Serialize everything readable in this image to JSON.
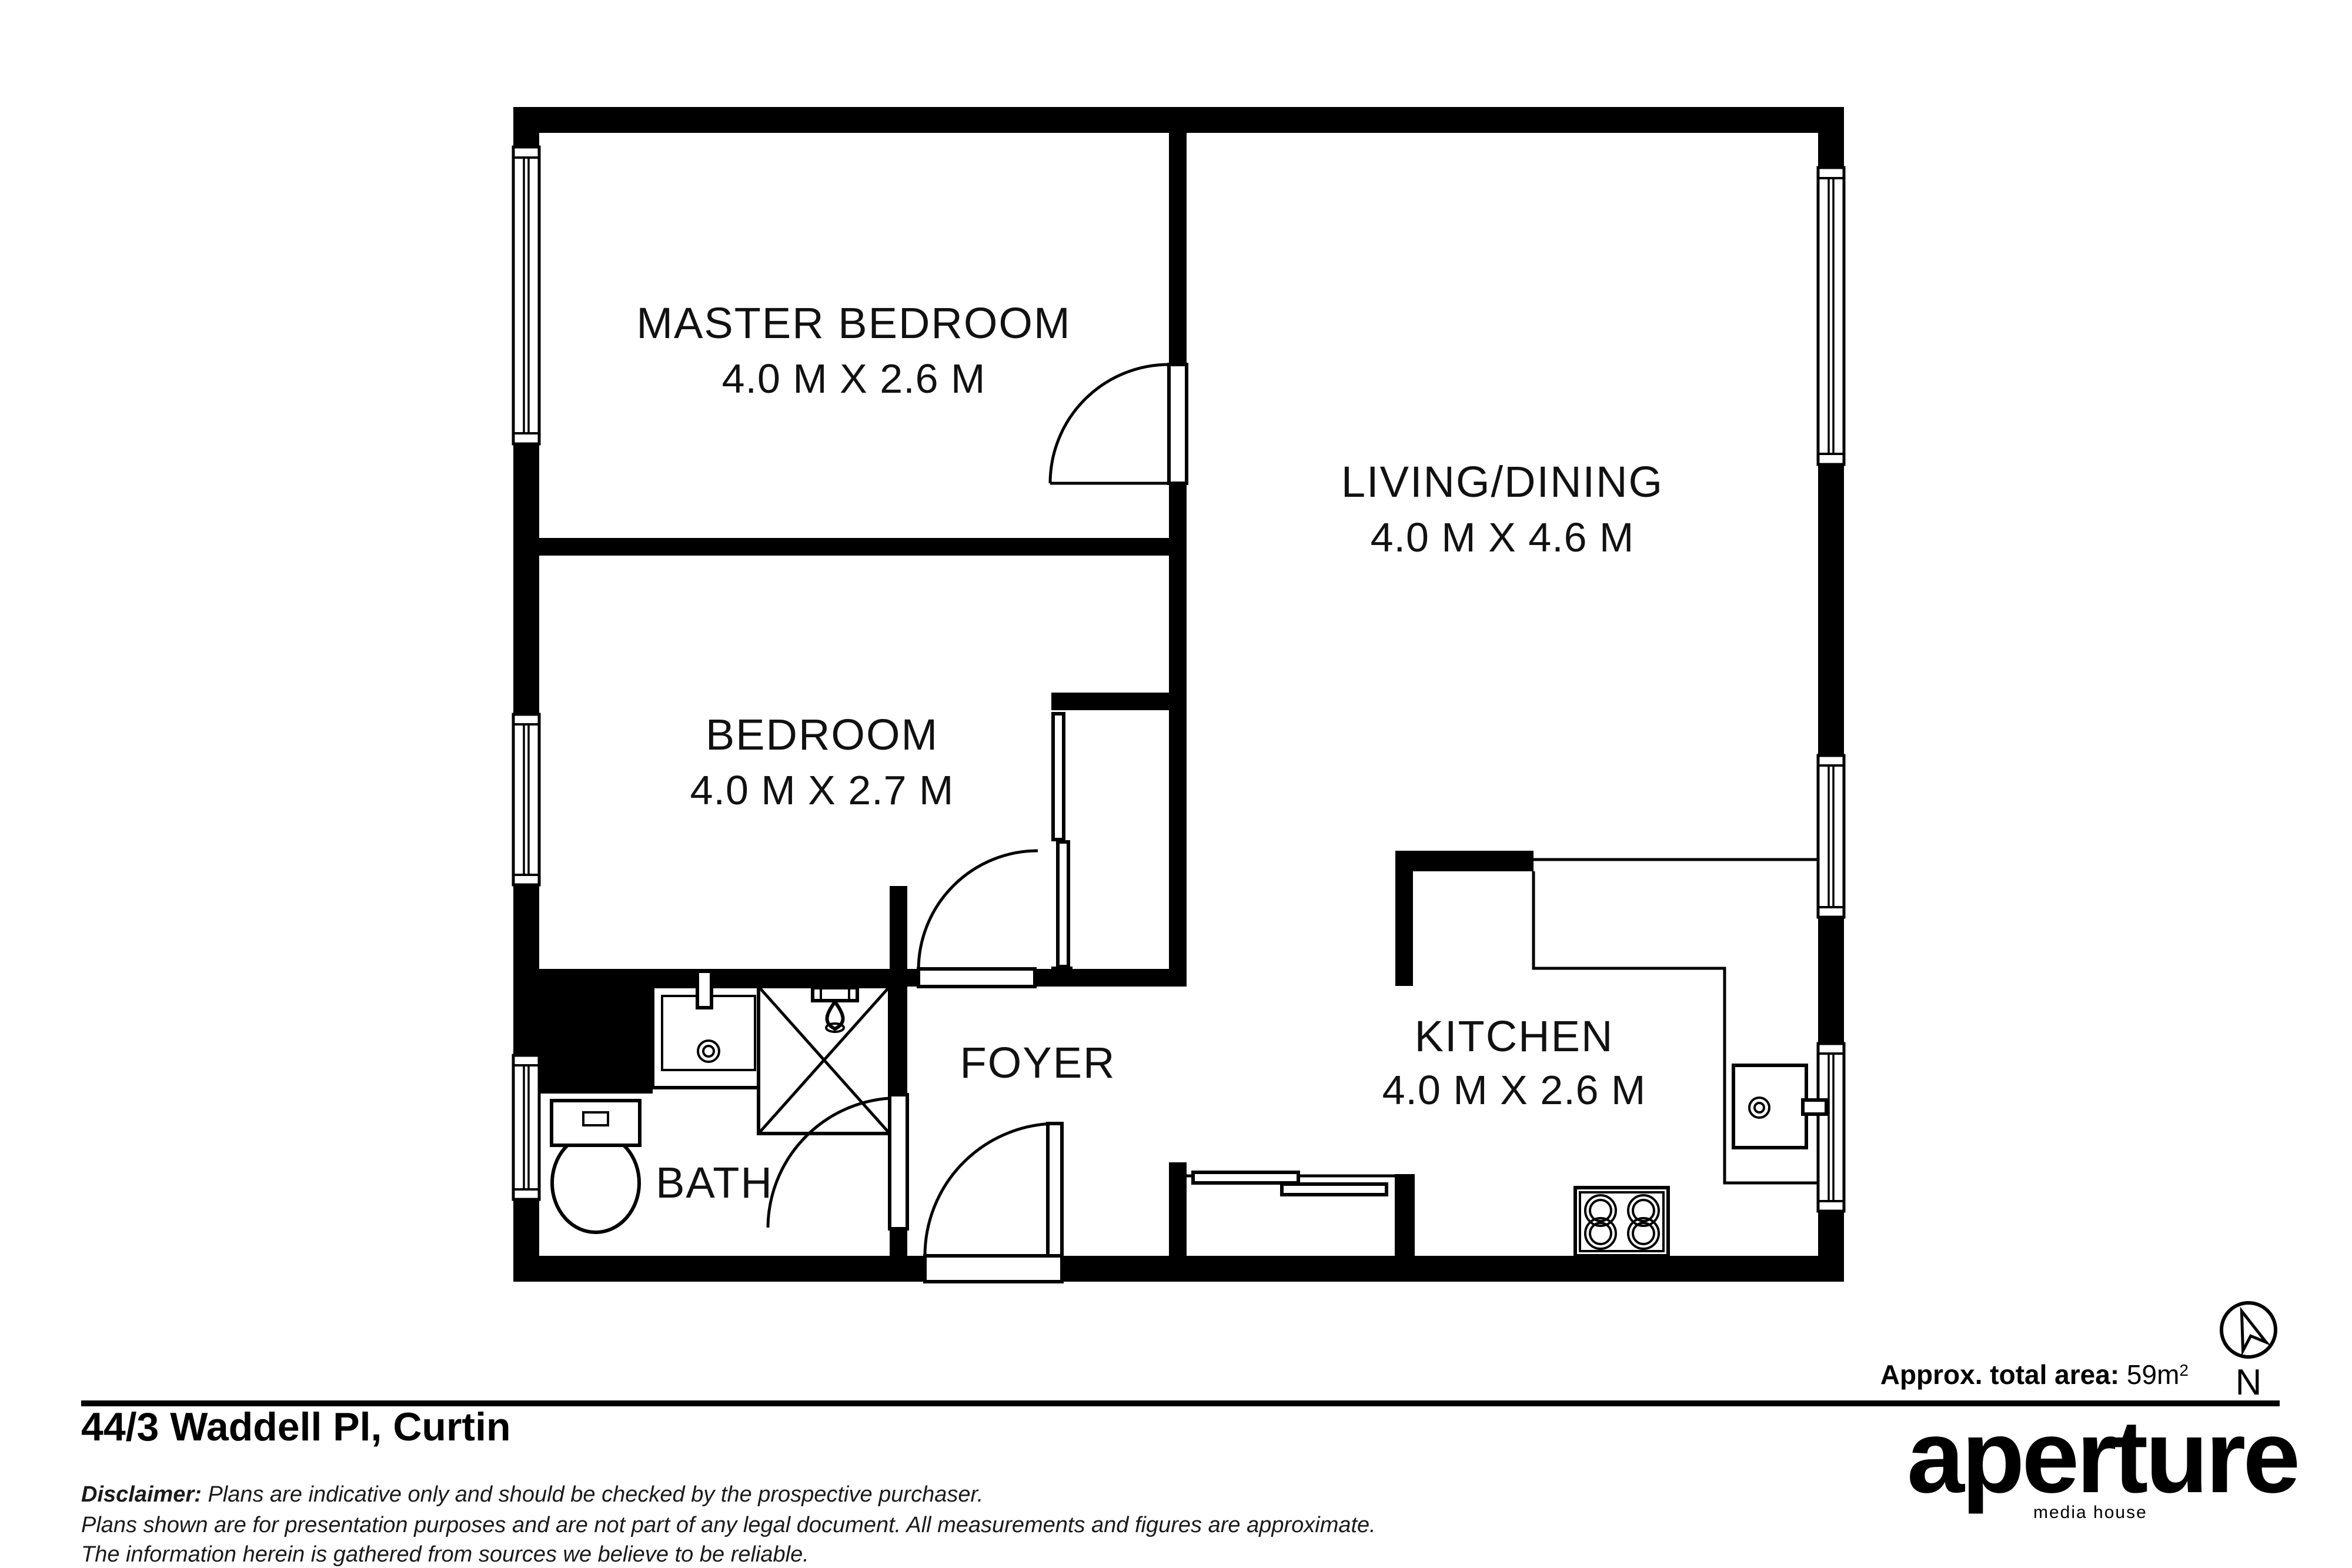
{
  "rooms": {
    "master": {
      "name": "MASTER BEDROOM",
      "dims": "4.0 M X 2.6 M"
    },
    "living": {
      "name": "LIVING/DINING",
      "dims": "4.0 M X 4.6 M"
    },
    "bedroom": {
      "name": "BEDROOM",
      "dims": "4.0 M X 2.7 M"
    },
    "kitchen": {
      "name": "KITCHEN",
      "dims": "4.0 M X 2.6 M"
    },
    "foyer": {
      "name": "FOYER"
    },
    "bath": {
      "name": "BATH"
    }
  },
  "footer": {
    "address": "44/3 Waddell Pl, Curtin",
    "area_label": "Approx. total area:",
    "area_value": " 59m",
    "area_sup": "2",
    "disclaimer_label": "Disclaimer:",
    "disclaimer_rest": " Plans are indicative only and should be checked by the prospective purchaser.",
    "disclaimer_line2": "Plans shown are for presentation purposes and are not part of any legal document. All measurements and figures are approximate.",
    "disclaimer_line3": "The information herein is gathered from sources we believe to be reliable.",
    "compass_letter": "N"
  },
  "brand": {
    "logo": "aperture",
    "tagline": "media house"
  }
}
